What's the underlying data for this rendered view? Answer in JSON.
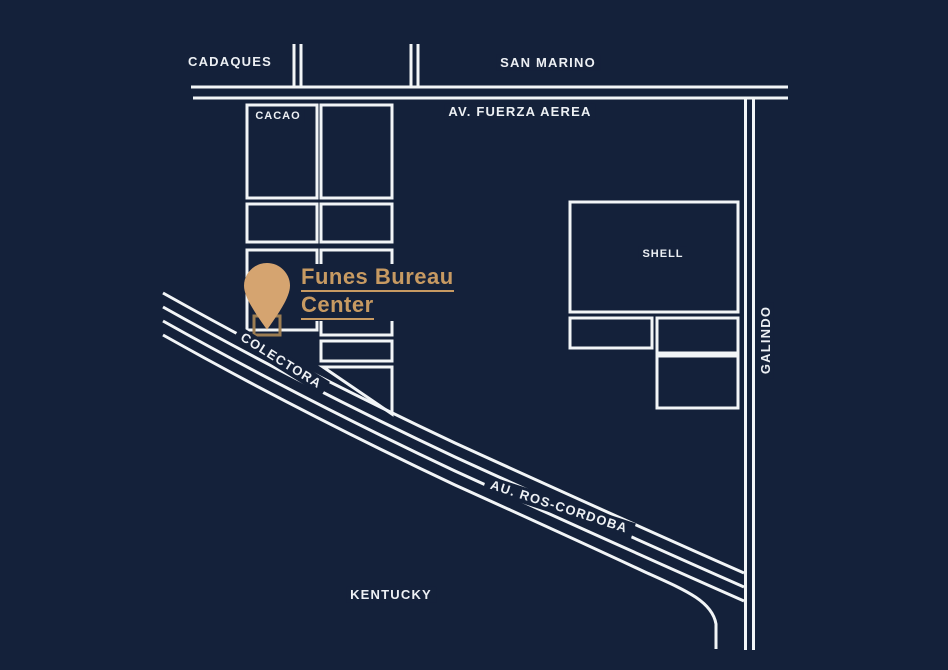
{
  "colors": {
    "background": "#14213A",
    "map_line": "#F2F5F7",
    "accent_text": "#C79A62",
    "pin": "#D5A470",
    "pin_block_outline": "#9C7D52"
  },
  "labels": {
    "cadaques": "CADAQUES",
    "san_marino": "SAN MARINO",
    "av_fuerza_aerea": "AV. FUERZA AEREA",
    "cacao": "CACAO",
    "shell": "SHELL",
    "galindo": "GALINDO",
    "colectora": "COLECTORA",
    "au_ros_cordoba": "AU. ROS-CORDOBA",
    "kentucky": "KENTUCKY"
  },
  "location": {
    "line1": "Funes Bureau",
    "line2": "Center"
  }
}
